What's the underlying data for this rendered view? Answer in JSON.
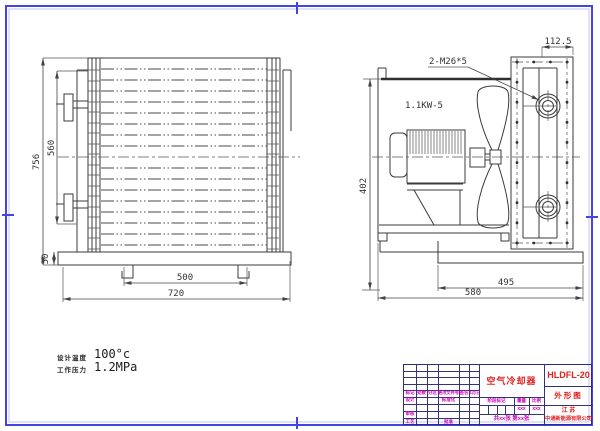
{
  "page": {
    "border_color": "#4343ea",
    "line_color": "#3b3b3b",
    "titleblock_text_magenta": "#cc00bb",
    "titleblock_text_red": "#e02222"
  },
  "specs": {
    "design_temp_label": "设计温度",
    "design_temp_value": "100°c",
    "working_pressure_label": "工作压力",
    "working_pressure_value": "1.2MPa"
  },
  "front_view": {
    "dims": {
      "overall_height": "756",
      "bundle_height": "560",
      "base_height": "50",
      "leg_spacing": "500",
      "overall_width": "720"
    }
  },
  "side_view": {
    "labels": {
      "motor": "1.1KW-5",
      "connections": "2-M26*5"
    },
    "dims": {
      "flange_offset": "112.5",
      "overall_height": "402",
      "pedestal_width": "495",
      "overall_width": "580"
    }
  },
  "title_block": {
    "product": "空气冷却器",
    "model": "HLDFL-20",
    "view_name": "外形图",
    "company_region": "江  苏",
    "company_name": "中通新能源有限公司",
    "rev_cols": {
      "mark": "标记",
      "count": "处数",
      "zone": "分区",
      "doc_no": "更改文件号",
      "sign": "签名",
      "date": "年月日"
    },
    "roles": {
      "design": "设计",
      "standardize": "标准化",
      "review": "审核",
      "process": "工艺",
      "approve": "批准"
    },
    "stage": {
      "label": "阶段标记",
      "weight": "重量",
      "scale": "比例",
      "weight_value": "xxx",
      "scale_value": "xxx"
    },
    "sheet": "共xx张 第xx张"
  }
}
